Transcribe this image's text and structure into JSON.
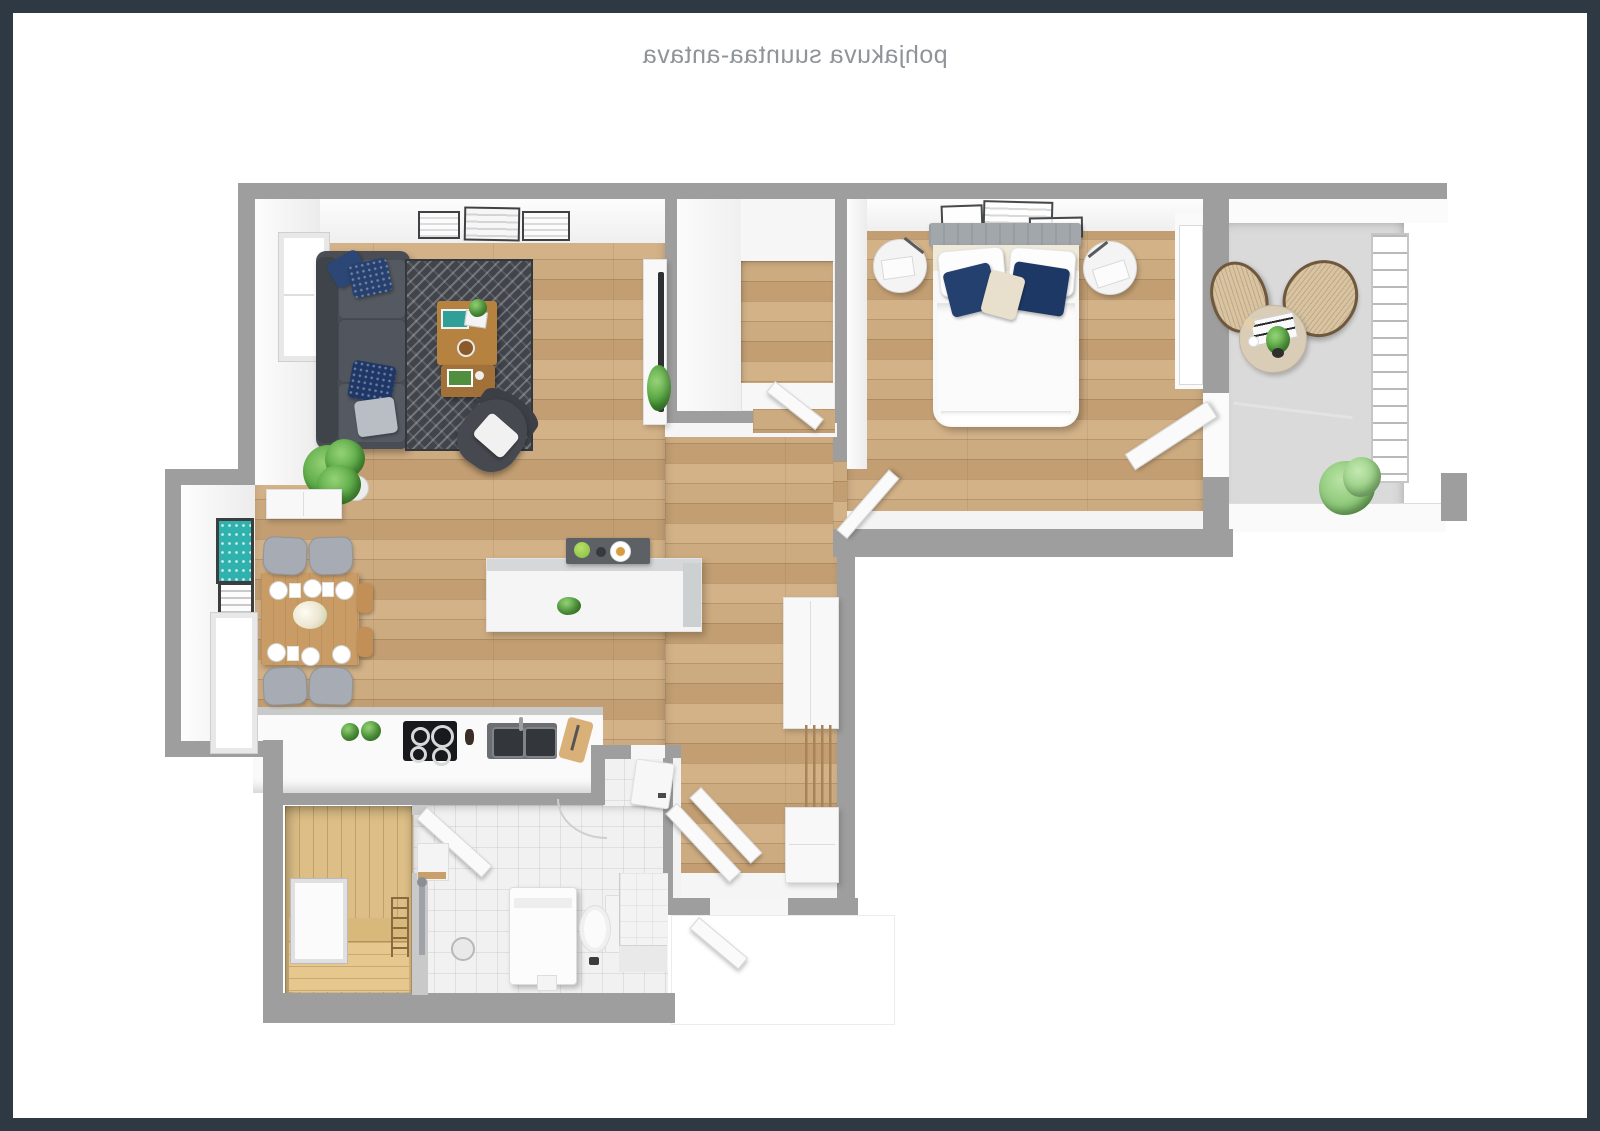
{
  "title": {
    "text": "pohjakuva suuntaa-antava",
    "mirrored": true
  },
  "colors": {
    "frame": "#2e3944",
    "wall": "#9e9e9e",
    "wood_floor": "#c9a87e",
    "tile_floor": "#f1f1f1",
    "sauna_wood": "#dcbe86",
    "balcony_floor": "#dadada",
    "sofa": "#4a4e54",
    "rug": "#41454b",
    "accent_pillow_navy": "#24406e",
    "art_teal": "#2fb2ad",
    "plant_green": "#5aa944",
    "coffee_table_wood": "#b5823f",
    "dining_table_wood": "#c99c66"
  },
  "rooms": [
    {
      "name": "living-room",
      "furniture": [
        "sofa",
        "patterned-rug",
        "coffee-table",
        "nesting-table",
        "armchair",
        "floor-plant",
        "wall-art-frames",
        "window",
        "tv-console"
      ]
    },
    {
      "name": "dining-nook",
      "furniture": [
        "dining-table",
        "chairs",
        "place-settings",
        "flower-centerpiece",
        "teal-wall-art",
        "small-wall-art",
        "window",
        "sideboard"
      ]
    },
    {
      "name": "kitchen",
      "furniture": [
        "island-with-tray",
        "bar-counter",
        "cooktop",
        "double-sink",
        "herb-pots",
        "cutting-board"
      ]
    },
    {
      "name": "walk-in-closet",
      "furniture": [
        "l-shaped-wardrobe",
        "door"
      ]
    },
    {
      "name": "bedroom",
      "furniture": [
        "double-bed",
        "headboard",
        "nightstand-left",
        "nightstand-right",
        "reading-lamps",
        "wall-frames",
        "door",
        "balcony-door"
      ]
    },
    {
      "name": "balcony",
      "furniture": [
        "rattan-chair-left",
        "rattan-chair-right",
        "round-table",
        "magazine",
        "cups",
        "table-plant",
        "bush-plant",
        "railing"
      ]
    },
    {
      "name": "entry-hall",
      "furniture": [
        "wardrobe",
        "coat-rack-slats",
        "shoe-cabinet",
        "entry-door"
      ]
    },
    {
      "name": "bathroom",
      "furniture": [
        "washing-machine",
        "toilet",
        "shower",
        "floor-drain",
        "corner-shelf",
        "tiled-bench",
        "sauna-door",
        "bathroom-door"
      ]
    },
    {
      "name": "sauna",
      "furniture": [
        "benches",
        "window",
        "towel-ladder"
      ]
    }
  ]
}
